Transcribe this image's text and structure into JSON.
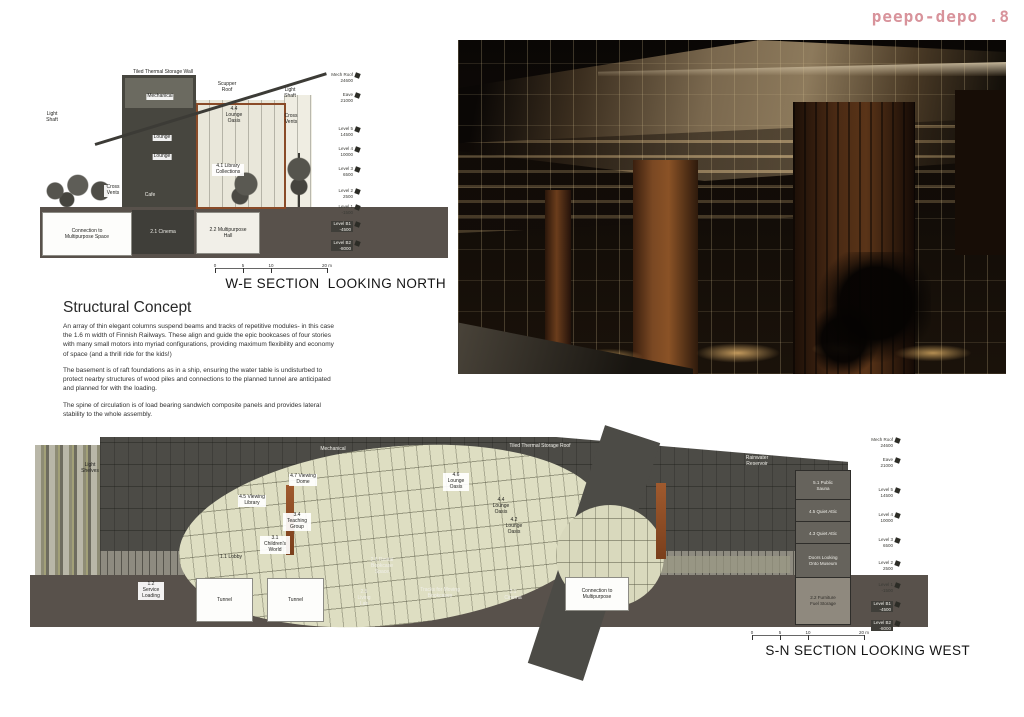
{
  "logo": {
    "text": "peepo-depo .8",
    "color": "#d8939b"
  },
  "levels": [
    {
      "name": "Mech Roof",
      "value": "24600"
    },
    {
      "name": "Eave",
      "value": "21000"
    },
    {
      "name": "Level 5",
      "value": "14500"
    },
    {
      "name": "Level 4",
      "value": "10000"
    },
    {
      "name": "Level 3",
      "value": "6500"
    },
    {
      "name": "Level 2",
      "value": "2500"
    },
    {
      "name": "Level 1",
      "value": "-1500"
    },
    {
      "name": "Level B1",
      "value": "-4500"
    },
    {
      "name": "Level B2",
      "value": "-8000"
    }
  ],
  "scale_bar": {
    "ticks": [
      "0",
      "5",
      "10",
      "20 m"
    ]
  },
  "we_section": {
    "caption": "W-E SECTION  LOOKING NORTH",
    "labels": {
      "thermal_wall": "Tiled Thermal Storage Wall",
      "mechanical": "Mechanical",
      "lounge_1": "Lounge",
      "lounge_2": "Lounge",
      "cafe": "Cafe",
      "light_shaft_left": "Light Shaft",
      "light_shaft_right": "Light Shaft",
      "cross_vents_right": "Cross Vents",
      "cross_vents_left": "Cross Vents",
      "scupper_roof": "Scupper Roof",
      "lounge_oasis": "4.4 Lounge Oasis",
      "library": "4.1 Library Collections",
      "connection": "Connection to Multipurpose Space",
      "cinema": "2.1 Cinema",
      "multipurpose_hall": "2.2 Multipurpose Hall"
    }
  },
  "structural_concept": {
    "heading": "Structural Concept",
    "paragraphs": [
      "An array of thin elegant columns suspend beams and tracks of repetitive modules- in this case the 1.6 m width of Finnish Railways. These align and guide the epic bookcases of four stories with many small motors into myriad configurations, providing maximum flexibility and economy of space (and a thrill ride for the kids!)",
      "The basement is of raft foundations as in a ship, ensuring the water table is undisturbed to protect nearby structures of wood piles and connections to the planned tunnel are anticipated and planned for with the loading.",
      "The spine of circulation is of load bearing sandwich composite panels and provides lateral stability to the whole assembly."
    ]
  },
  "sn_section": {
    "caption": "S-N SECTION LOOKING WEST",
    "labels": {
      "light_shelves": "Light Shelves",
      "mechanical": "Mechanical",
      "thermal_roof": "Tiled Thermal Storage Roof",
      "rainwater": "Rainwater Reservoir",
      "viewing_dome": "4.7 Viewing Dome",
      "viewing_library": "4.5 Viewing Library",
      "teaching_group": "3.4 Teaching Group",
      "childrens_world": "3.1 Children's World",
      "lounge_oasis_1": "4.6 Lounge Oasis",
      "lounge_oasis_2": "4.4 Lounge Oasis",
      "lounge_oasis_3": "4.2 Lounge Oasis",
      "lobby": "1.1 Lobby",
      "service_loading": "1.2 Service Loading",
      "tunnel_1": "Tunnel",
      "tunnel_2": "Tunnel",
      "rental": "2.6 Rental Bookcase Space",
      "living_lab": "2.5 Living Lab",
      "tracks": "Tracks for Moving Bookcases",
      "cinema": "2.1 Cinema",
      "connection": "Connection to Multipurpose",
      "public_sauna": "5.1 Public Sauna",
      "quiet_attic_1": "4.5 Quiet Attic",
      "quiet_attic_2": "4.3 Quiet Attic",
      "doors_museum": "Doors Looking Onto Museum",
      "furniture_storage": "2.2 Furniture Fuel Storage"
    }
  }
}
